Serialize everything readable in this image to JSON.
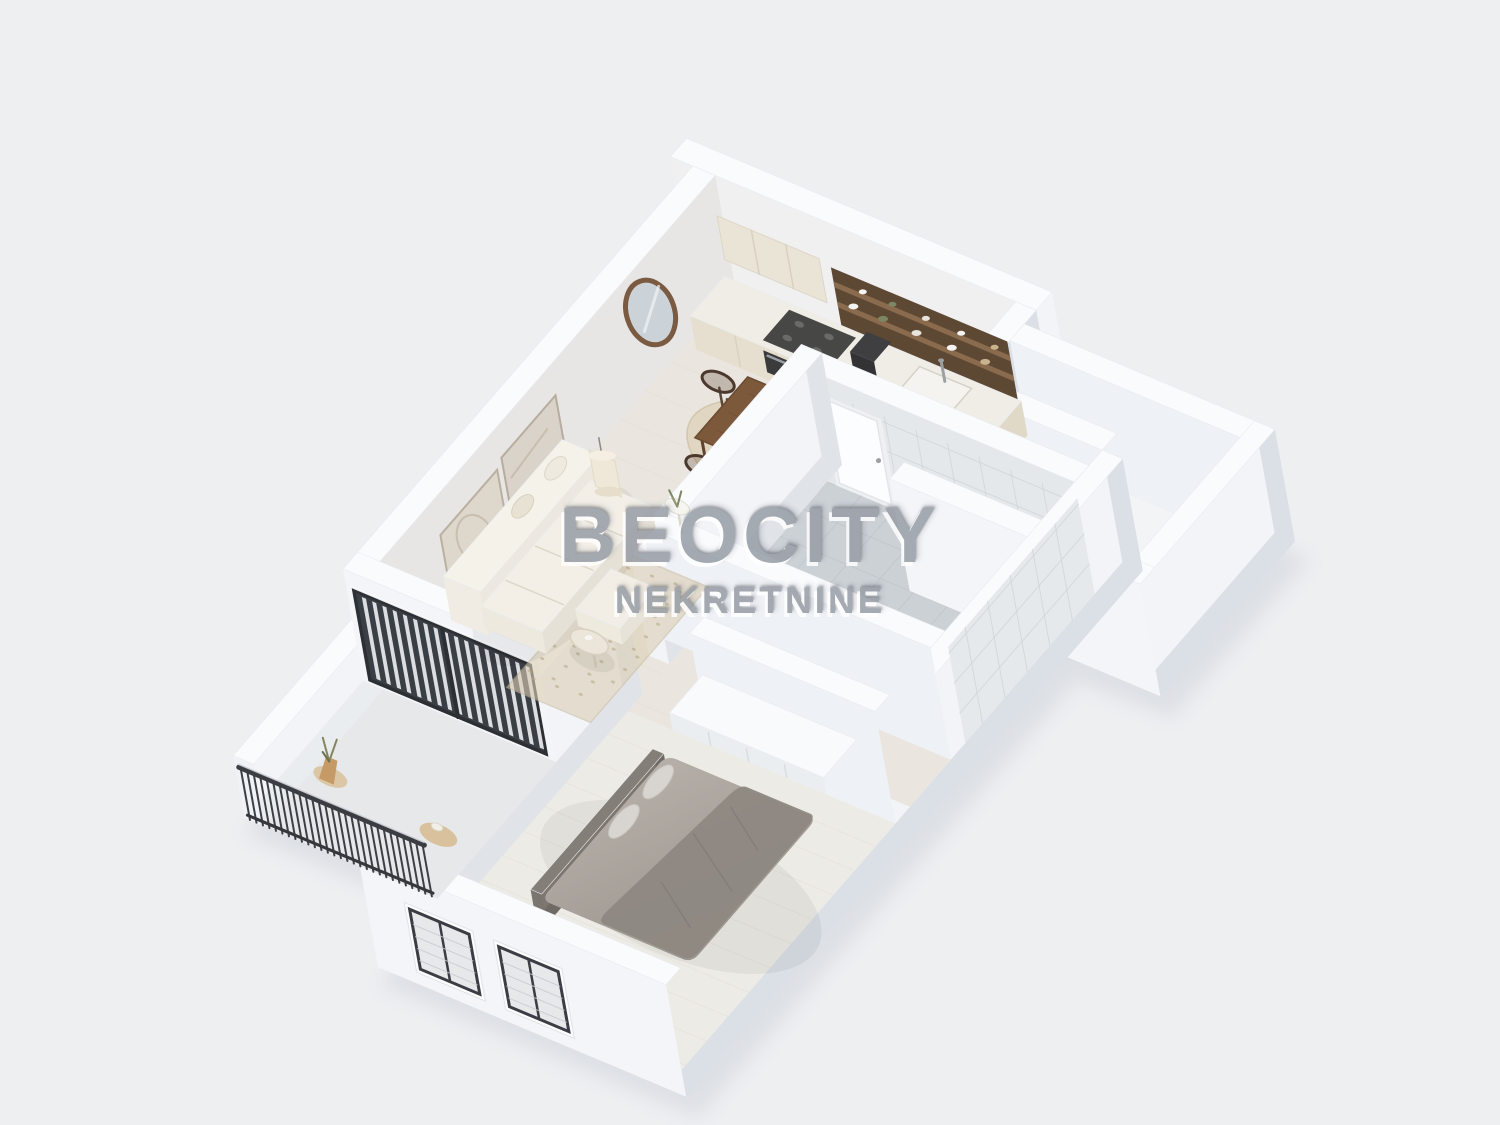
{
  "page": {
    "background": "#edeff1"
  },
  "watermark": {
    "title": "BEOCITY",
    "subtitle": "NEKRETNINE",
    "color": "#9aa0a8"
  },
  "floorplan": {
    "view": "isometric-3d-apartment-render",
    "rooms": [
      "living-room",
      "dining-area",
      "kitchen",
      "bathroom",
      "hallway",
      "bedroom",
      "balcony",
      "terrace"
    ],
    "furniture": [
      "sofa",
      "coffee-table",
      "side-table",
      "pendant-lamp",
      "wall-art-frames",
      "round-mirror",
      "area-rug",
      "jute-rug",
      "dining-table",
      "dining-chairs",
      "kitchen-cabinets",
      "upper-cabinets",
      "open-shelves",
      "cooktop",
      "oven",
      "kitchen-sink",
      "bed",
      "pillows",
      "blanket",
      "wardrobe",
      "bedroom-windows",
      "balcony-railing",
      "glass-sliding-door",
      "potted-plant",
      "bathroom-tiles",
      "shower-area",
      "stool"
    ]
  },
  "colors": {
    "background": "#edeff1",
    "shadow": "#c9ced6",
    "wallTop": "#fafbfd",
    "wallBright": "#f2f4f7",
    "wallBrightS": "#f3f5f8",
    "wallW": "#ecseff",
    "wallWest": "#edf0f4",
    "wallEast": "#dbe0e6",
    "wallInnerWarm": "#e8e5e5",
    "wallInnerNE": "#f0f0f1",
    "wallInnerSoft": "#eef1f5",
    "wallShadowE": "#e0e4e9",
    "floorLiving": "#eae6df",
    "floorBed": "#edebe6",
    "floorBalcony": "#e6e8ea",
    "floorExt": "#f3f4f6",
    "bathFloor": "#ccd1d6",
    "bathFloorDark": "#b3b9c0",
    "tileWall": "#e4e8eb",
    "tileLine": "#d0d5da",
    "cabinet": "#eae4d7",
    "cabinetFront": "#e6dfcf",
    "counter": "#f0ede6",
    "stove": "#474746",
    "oven": "#3b3b3c",
    "sink": "#f4f3f0",
    "shelfDark": "#5d4834",
    "shelfWood": "#8a6b4d",
    "wood": "#7d593c",
    "woodDark": "#5f4430",
    "chairWood": "#4a392c",
    "rugJute": "#d5c5a5",
    "rugBerber": "#dccfb5",
    "sofa1": "#f3f0e9",
    "sofa2": "#eae5da",
    "bedDuvetA": "#bcb6af",
    "bedDuvetB": "#9a948d",
    "bedBlanket": "#8e8882",
    "pillow": "#d8d4cf",
    "headboard": "#6f6a64",
    "railing": "#34373c",
    "doorFrame": "#2c2f33",
    "glassDark": "#3a3f45",
    "blindWhite": "#eef0f2",
    "winFrame": "#fbfcfd",
    "winBlind": "#e6e8ea",
    "winDark": "#3a3e44",
    "mirrorFrame": "#7a5b41",
    "mirrorGlass": "#ccd3d8",
    "lampShade": "#efe8d8",
    "plantPot": "#c59a66",
    "plantGreen": "#7d8663",
    "white": "#ffffff"
  }
}
